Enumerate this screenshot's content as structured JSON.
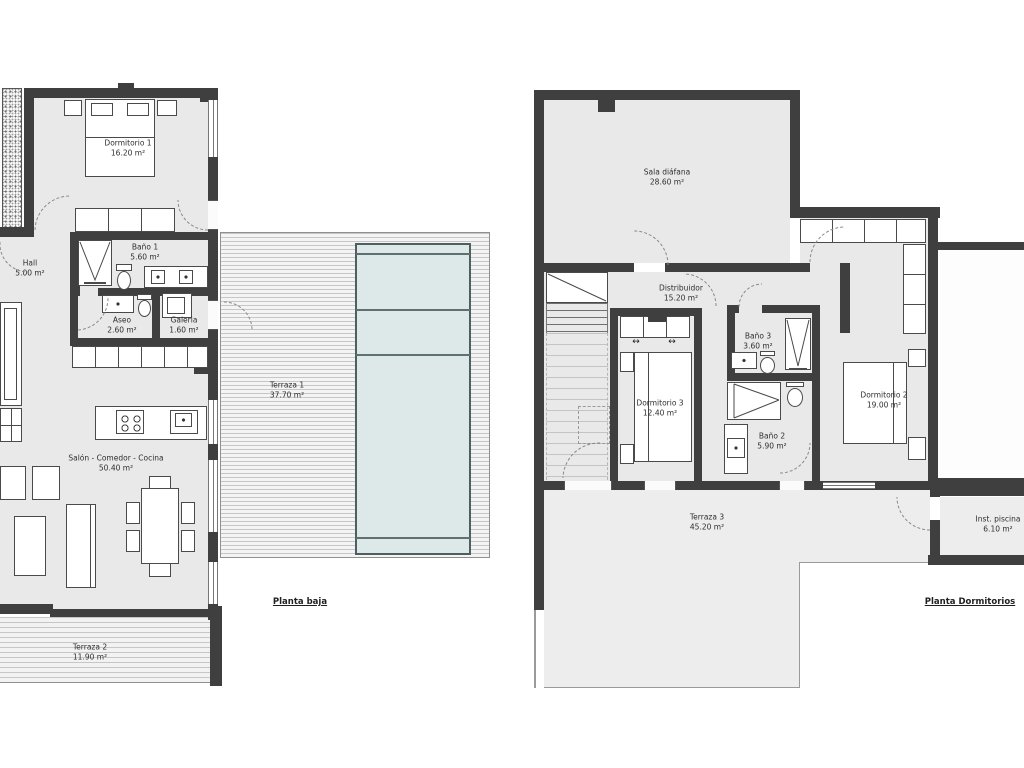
{
  "document": {
    "background": "#ffffff"
  },
  "palette": {
    "wall": "#3f3f3f",
    "floor": "#e9e9e9",
    "terrace_floor": "#ededed",
    "deck_line": "#c6c6c6",
    "pool_fill": "#dce9e8",
    "pool_line": "#5f7070",
    "label_text": "#2e2e2e"
  },
  "glyphs": {
    "slide_arrow": "↔"
  },
  "plans": [
    {
      "title": "Planta baja",
      "rooms": [
        {
          "name": "Dormitorio 1",
          "area": "16.20 m²"
        },
        {
          "name": "Hall",
          "area": "5.00 m²"
        },
        {
          "name": "Baño 1",
          "area": "5.60 m²"
        },
        {
          "name": "Aseo",
          "area": "2.60 m²"
        },
        {
          "name": "Galeria",
          "area": "1.60 m²"
        },
        {
          "name": "Terraza 1",
          "area": "37.70 m²"
        },
        {
          "name": "Salón - Comedor - Cocina",
          "area": "50.40 m²"
        },
        {
          "name": "Terraza 2",
          "area": "11.90 m²"
        }
      ]
    },
    {
      "title": "Planta Dormitorios",
      "rooms": [
        {
          "name": "Sala diáfana",
          "area": "28.60 m²"
        },
        {
          "name": "Distribuidor",
          "area": "15.20 m²"
        },
        {
          "name": "Dormitorio 3",
          "area": "12.40 m²"
        },
        {
          "name": "Baño 3",
          "area": "3.60 m²"
        },
        {
          "name": "Baño 2",
          "area": "5.90 m²"
        },
        {
          "name": "Dormitorio 2",
          "area": "19.00 m²"
        },
        {
          "name": "Terraza 3",
          "area": "45.20 m²"
        },
        {
          "name": "Inst. piscina",
          "area": "6.10 m²"
        }
      ]
    }
  ]
}
